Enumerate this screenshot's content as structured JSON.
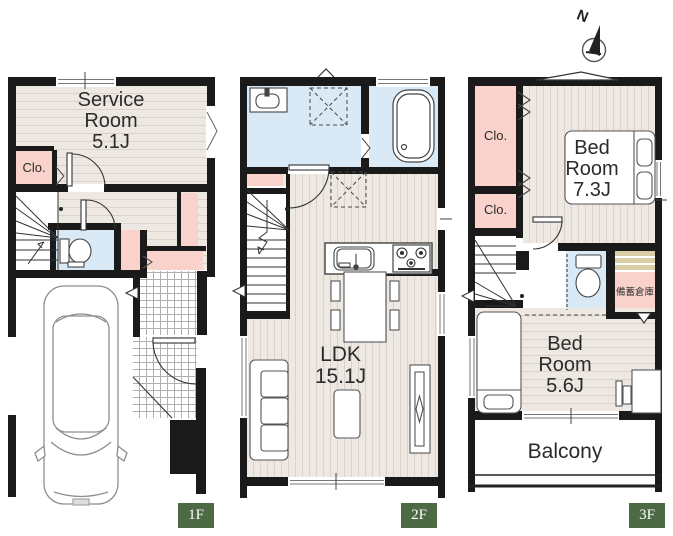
{
  "compass": {
    "north_label": "N"
  },
  "floors": {
    "f1": {
      "tag": "1F",
      "service_room": {
        "line1": "Service",
        "line2": "Room",
        "line3": "5.1J"
      },
      "closet": "Clo."
    },
    "f2": {
      "tag": "2F",
      "ldk": {
        "line1": "LDK",
        "line2": "15.1J"
      }
    },
    "f3": {
      "tag": "3F",
      "closet1": "Clo.",
      "closet2": "Clo.",
      "bedroom_main": {
        "line1": "Bed",
        "line2": "Room",
        "line3": "7.3J"
      },
      "bedroom_second": {
        "line1": "Bed",
        "line2": "Room",
        "line3": "5.6J"
      },
      "storage": "備蓄倉庫",
      "balcony": "Balcony"
    }
  },
  "colors": {
    "wall": "#1a1a1a",
    "closet_pink": "#f8d2cb",
    "wet_area_blue": "#d9eaf6",
    "wood_floor": "#ece7e2",
    "shelf_tan": "#d8cda5",
    "floor_tag_green": "#4c6a43",
    "label_text": "#2b2b2b"
  }
}
